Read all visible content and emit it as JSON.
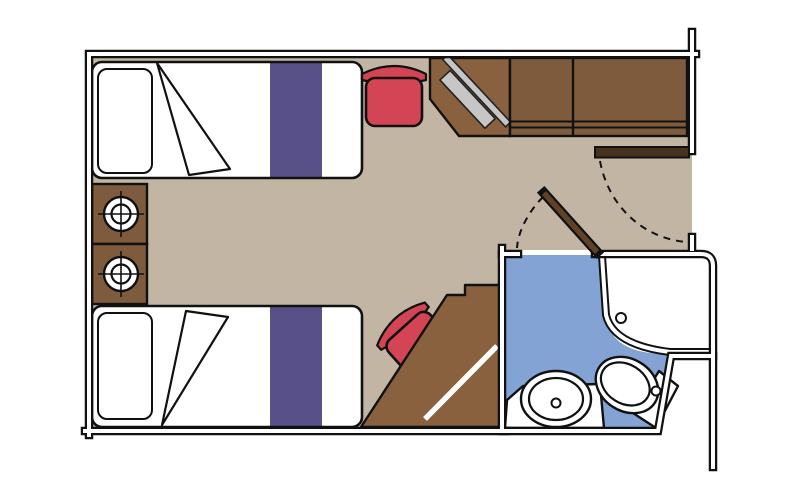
{
  "plan": {
    "type": "floorplan",
    "title": "cruise-cabin-stateroom-floorplan",
    "areas": [
      {
        "name": "cabin",
        "floor": "beige"
      },
      {
        "name": "bathroom",
        "floor": "blue"
      }
    ],
    "furniture": [
      "twin-bed-top",
      "twin-bed-bottom",
      "nightstand-upper",
      "nightstand-lower",
      "lamp-upper",
      "lamp-lower",
      "stool-top",
      "stool-bottom",
      "desk-with-tv",
      "vanity-desk-with-mirror",
      "wardrobe",
      "entry-door",
      "bathroom-door",
      "shower",
      "sink-counter",
      "sink",
      "toilet"
    ]
  },
  "colors": {
    "background": "#ffffff",
    "outline": "#111111",
    "wall_core": "#ffffff",
    "floor": "#c2b5a4",
    "bathroom_floor": "#83a3d5",
    "wood": "#7f5b3d",
    "wood_light": "#8a613e",
    "bed_white": "#ffffff",
    "bed_stripe": "#575089",
    "chair_red": "#d34454",
    "tv_gray": "#c6c6c6",
    "entry_door": "#46331f",
    "bathroom_door": "#5f4228"
  }
}
